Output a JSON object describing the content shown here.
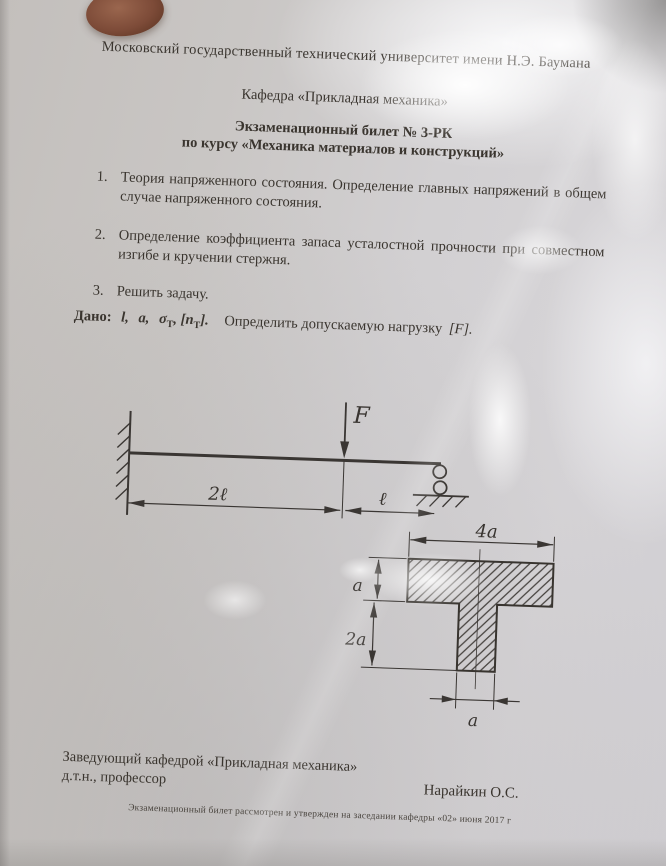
{
  "document": {
    "university": "Московский государственный технический университет имени Н.Э. Баумана",
    "department": "Кафедра «Прикладная механика»",
    "ticket_title": "Экзаменационный билет № 3-РК",
    "course_line": "по курсу «Механика материалов и конструкций»",
    "questions": [
      {
        "num": "1.",
        "text": "Теория напряженного состояния. Определение главных напряжений в общем случае напряженного состояния."
      },
      {
        "num": "2.",
        "text": "Определение коэффициента запаса усталостной прочности при совместном изгибе и кручении стержня."
      },
      {
        "num": "3.",
        "text": "Решить задачу."
      }
    ],
    "given": {
      "label": "Дано:",
      "sym_l": "l,",
      "sym_a": "a,",
      "sym_sigma": "σ",
      "sym_sigma_sub": "Т",
      "sym_n_pre": ", [n",
      "sym_n_sub": "Т",
      "sym_n_post": "].",
      "task": "Определить допускаемую нагрузку",
      "task_load": "[F]."
    },
    "footer": {
      "head_position_line1": "Заведующий кафедрой «Прикладная механика»",
      "head_position_line2": "д.т.н., профессор",
      "signature_name": "Нарайкин О.С.",
      "approval_note": "Экзаменационный билет рассмотрен и утвержден на заседании кафедры «02»  июня 2017 г"
    }
  },
  "beam_diagram": {
    "force_label": "F",
    "dim_left_label": "2ℓ",
    "dim_right_label": "ℓ"
  },
  "section_diagram": {
    "dim_top": "4a",
    "dim_flange_thickness": "a",
    "dim_web_height": "2a",
    "dim_web_width": "a"
  },
  "photo": {
    "paper_color": "#cfcdd1",
    "ink_color": "#3a3633",
    "fingertip_color": "#7d4b38"
  }
}
